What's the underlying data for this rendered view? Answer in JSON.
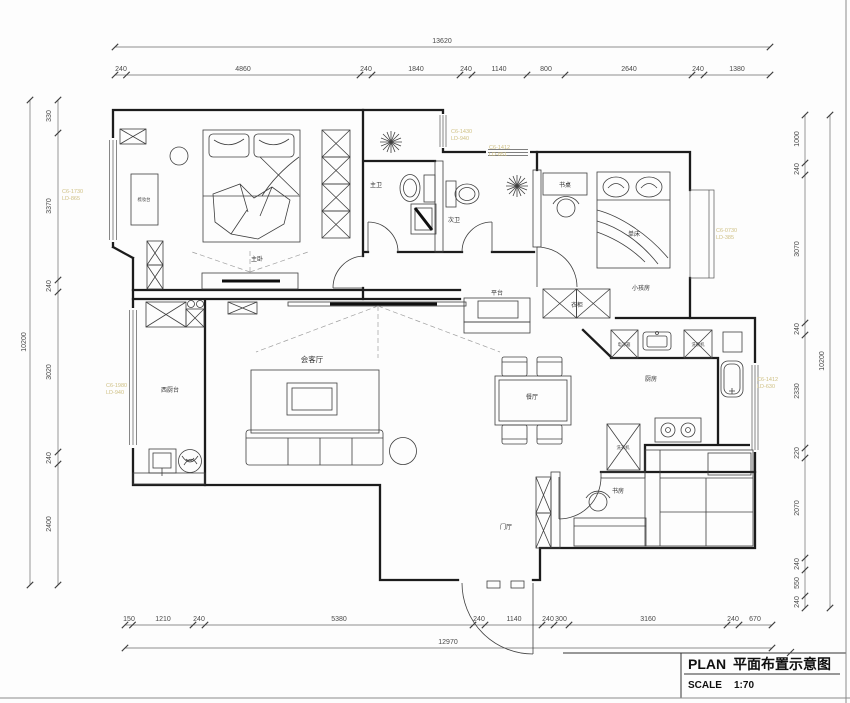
{
  "title_block": {
    "plan_label": "PLAN",
    "plan_name": "平面布置示意图",
    "scale_label": "SCALE",
    "scale_value": "1:70"
  },
  "dimensions": {
    "top": {
      "total": "13620",
      "segments": [
        "240",
        "4860",
        "240",
        "1840",
        "240",
        "1140",
        "800",
        "2640",
        "240",
        "1380"
      ]
    },
    "bottom": {
      "total": "12970",
      "segments": [
        "150",
        "1210",
        "240",
        "5380",
        "240",
        "1140",
        "240",
        "300",
        "3160",
        "240",
        "670"
      ]
    },
    "left": {
      "total": "10200",
      "segments": [
        "330",
        "3370",
        "240",
        "3020",
        "240",
        "2400"
      ]
    },
    "right": {
      "total": "10200",
      "segments": [
        "1000",
        "240",
        "3070",
        "240",
        "2330",
        "220",
        "2070",
        "240",
        "550",
        "240"
      ]
    }
  },
  "rooms": {
    "master_bedroom": "主卧",
    "master_bath": "主卫",
    "second_bath": "次卫",
    "kids_room": "小孩房",
    "living_room": "会客厅",
    "dining_room": "餐厅",
    "kitchen": "厨房",
    "study": "书房",
    "entry": "门厅",
    "west_kitchen": "西厨台",
    "platform": "平台"
  },
  "furniture": {
    "wardrobe": "衣柜",
    "desk": "书桌",
    "bed": "单床",
    "dresser": "梳妆台",
    "fridge": "电冰箱",
    "dishwasher": "洗碗机",
    "washer": "洗衣机"
  },
  "window_codes": [
    {
      "line1": "C6-1730",
      "line2": "LD-865"
    },
    {
      "line1": "C6-1980",
      "line2": "LD-940"
    },
    {
      "line1": "C6-1430",
      "line2": "LD-940"
    },
    {
      "line1": "C6-1412",
      "line2": "LD-851"
    },
    {
      "line1": "C6-0730",
      "line2": "LD-385"
    },
    {
      "line1": "C6-1412",
      "line2": "LD-630"
    }
  ],
  "colors": {
    "wall_line": "#1c1c1c",
    "annotation": "#cfc084",
    "background": "#fdfdfd"
  }
}
